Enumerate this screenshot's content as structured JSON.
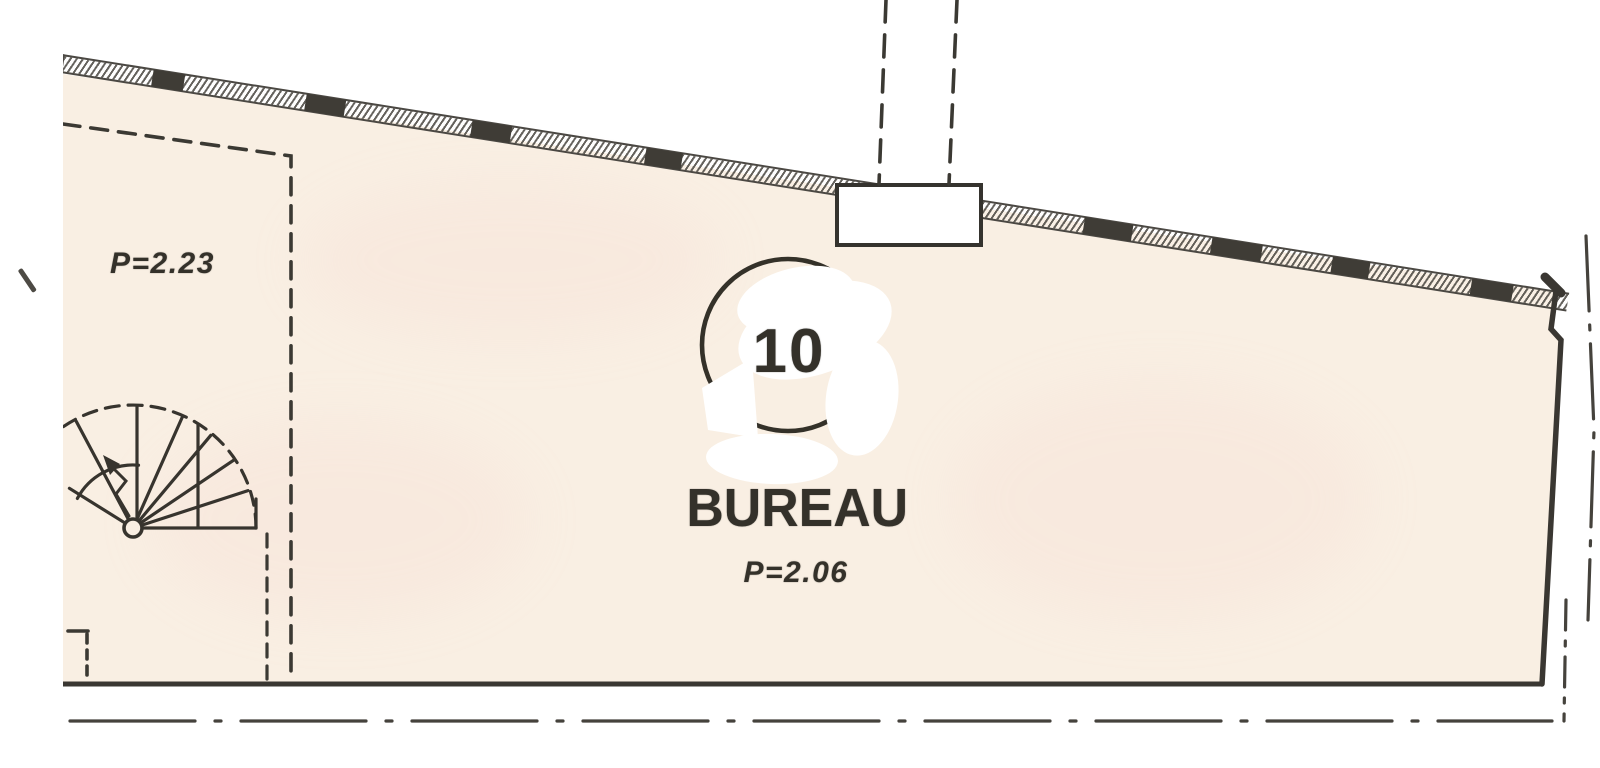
{
  "document": {
    "type": "scanned architectural floor plan",
    "room": {
      "number": "10",
      "name": "BUREAU",
      "ceiling_height_label": "P=2.06"
    },
    "adjacent_zone": {
      "ceiling_height_label": "P=2.23"
    }
  },
  "colors": {
    "paper_white": "#ffffff",
    "room_fill": "#f9efe3",
    "line_ink": "#35332d",
    "wall_hatch": "#4b4843",
    "whiteout": "#ffffff"
  },
  "features": {
    "spiral_staircase": "winder stair fan, lower left",
    "chimney_flue": "dashed flue lines into wall box, top center",
    "whiteout_mark": "white correction blob over room number circle",
    "attic_boundary": "dashed low-ceiling boundary, upper left",
    "axis_line": "dash-dot property axis below bottom wall"
  }
}
